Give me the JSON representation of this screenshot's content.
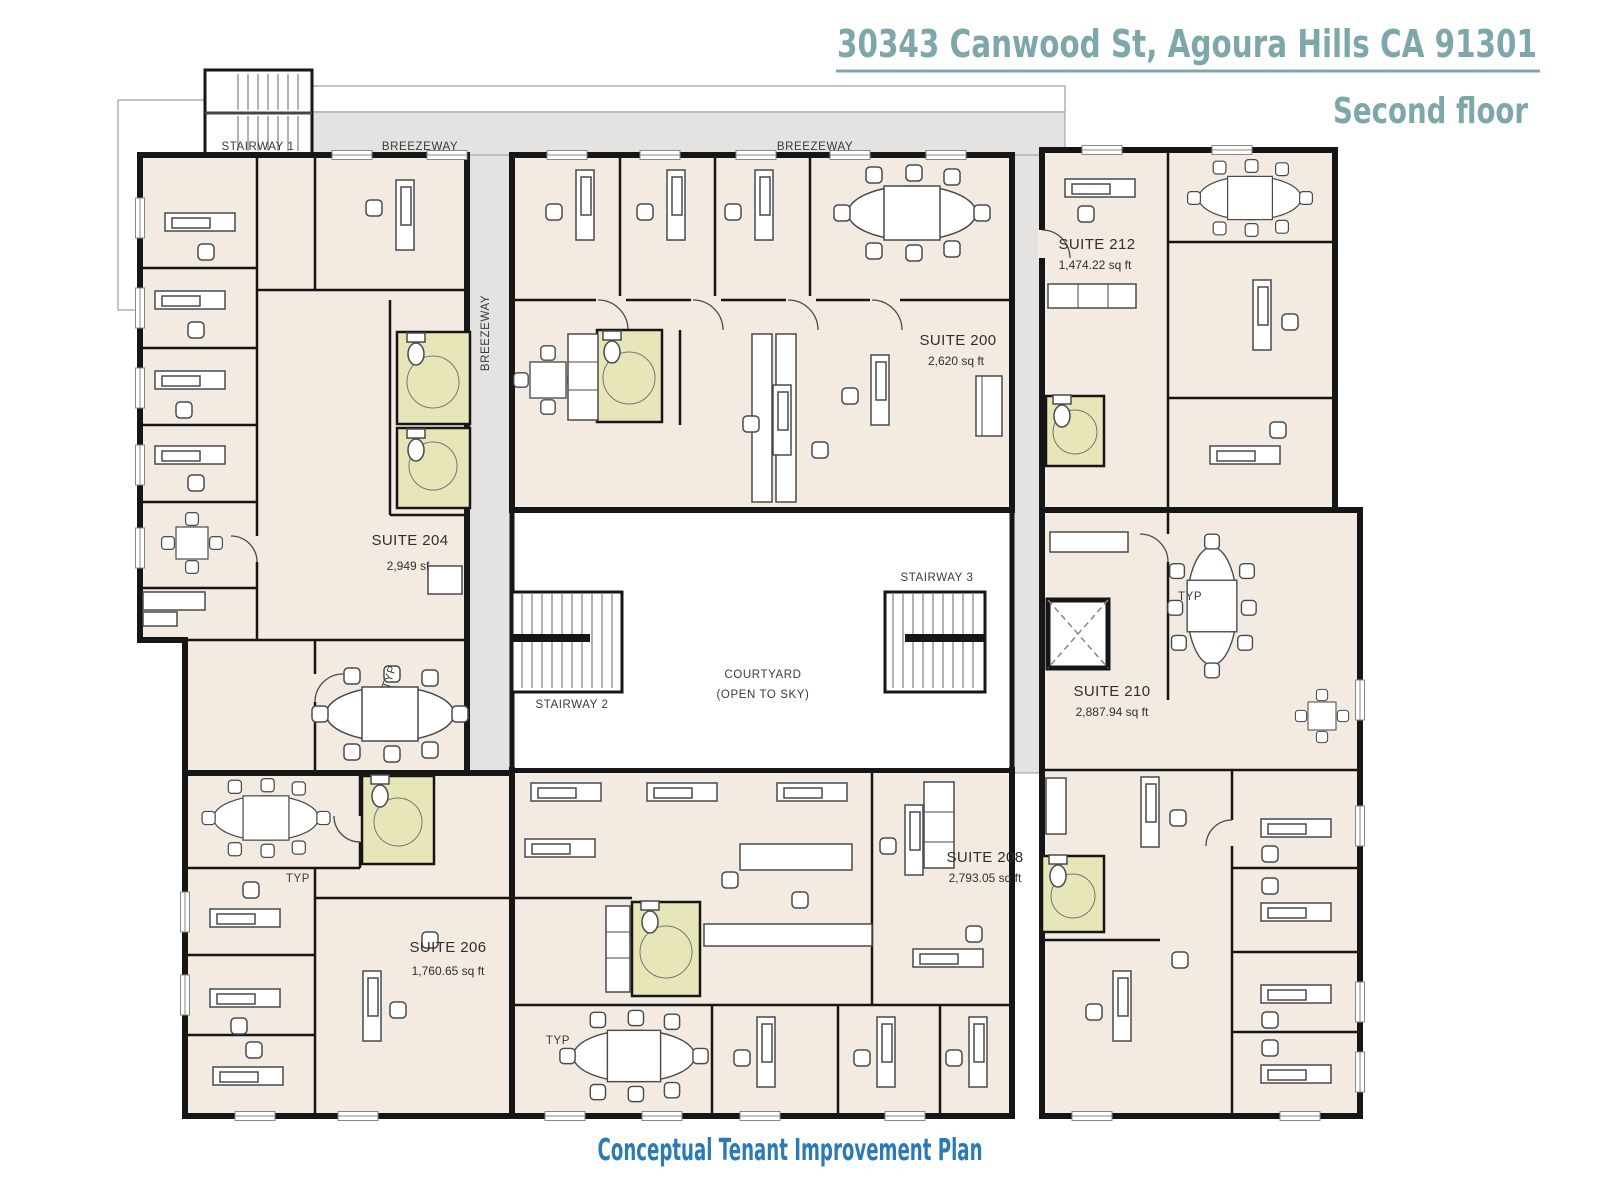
{
  "header": {
    "address": "30343 Canwood St, Agoura Hills  CA 91301",
    "floor": "Second floor"
  },
  "footer": {
    "caption": "Conceptual Tenant Improvement Plan"
  },
  "labels": {
    "stairway1": "STAIRWAY 1",
    "stairway2": "STAIRWAY 2",
    "stairway3": "STAIRWAY 3",
    "breezeway": "BREEZEWAY",
    "courtyard1": "COURTYARD",
    "courtyard2": "(OPEN TO SKY)",
    "typ": "TYP",
    "typ_alt": "TYP."
  },
  "suites": [
    {
      "id": "200",
      "name": "SUITE 200",
      "area": "2,620 sq ft"
    },
    {
      "id": "204",
      "name": "SUITE 204",
      "area": "2,949 sf"
    },
    {
      "id": "206",
      "name": "SUITE 206",
      "area": "1,760.65 sq ft"
    },
    {
      "id": "208",
      "name": "SUITE 208",
      "area": "2,793.05 sq ft"
    },
    {
      "id": "210",
      "name": "SUITE 210",
      "area": "2,887.94 sq ft"
    },
    {
      "id": "212",
      "name": "SUITE 212",
      "area": "1,474.22 sq ft"
    }
  ],
  "colors": {
    "accent": "#7ea7ac",
    "caption": "#2b7ab8",
    "floor": "#f3eae2",
    "walkway": "#e4e3e1",
    "restroom": "#e7e6b8",
    "wall": "#161616"
  }
}
